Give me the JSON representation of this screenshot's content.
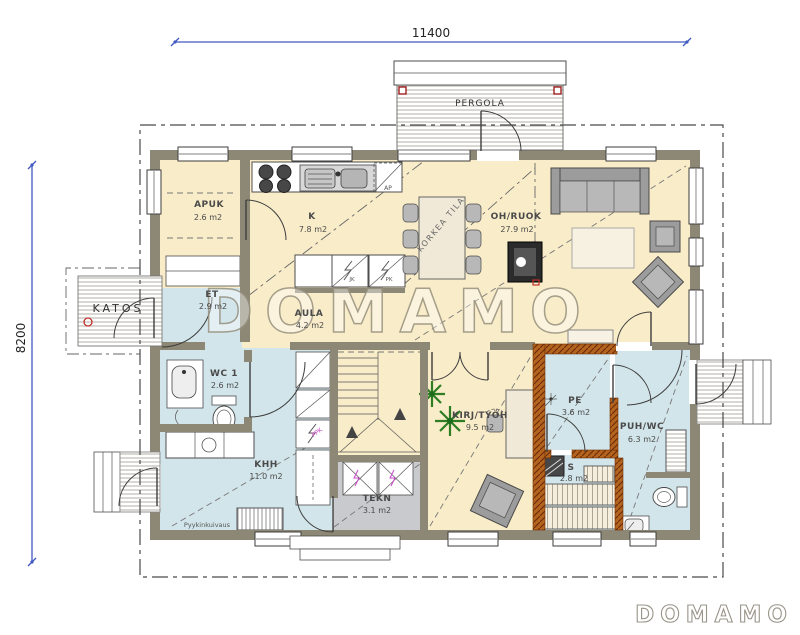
{
  "dimensions": {
    "width": "11400",
    "height": "8200"
  },
  "outdoor": {
    "pergola": "PERGOLA",
    "katos": "KATOS"
  },
  "rooms": {
    "apuk": {
      "name": "APUK",
      "area": "2.6 m2"
    },
    "k": {
      "name": "K",
      "area": "7.8 m2"
    },
    "oh_ruok": {
      "name": "OH/RUOK",
      "area": "27.9 m2"
    },
    "et": {
      "name": "ET",
      "area": "2.9 m2"
    },
    "aula": {
      "name": "AULA",
      "area": "4.2 m2"
    },
    "wc1": {
      "name": "WC 1",
      "area": "2.6 m2"
    },
    "khh": {
      "name": "KHH",
      "area": "11.0 m2"
    },
    "tekn": {
      "name": "TEKN",
      "area": "3.1 m2"
    },
    "kirj_tyoh": {
      "name": "KIRJ/TYÖH",
      "area": "9.5 m2"
    },
    "pe": {
      "name": "PE",
      "area": "3.6 m2"
    },
    "puh_wc": {
      "name": "PUH/WC",
      "area": "6.3 m2"
    },
    "s": {
      "name": "S",
      "area": "2.8 m2"
    }
  },
  "annotations": {
    "korkea_tila": "KORKEA TILA",
    "pyykinkuivaus": "Pyykinkuivaus",
    "ap": "AP",
    "jk": "JK",
    "pk": "PK",
    "ppk": "PPK"
  },
  "watermark": "DOMAMO",
  "logo": "DOMAMO",
  "colors": {
    "wall": "#8d8875",
    "room_warm": "#f9ecc9",
    "room_wet_floor": "#d2e5ea",
    "room_tech": "#c9cacd",
    "sauna_wall": "#b4641e",
    "dimension_blue": "#4059c0",
    "accent_red": "#c03028",
    "label_magenta": "#cc44cc",
    "plant_green": "#2e7d22"
  }
}
